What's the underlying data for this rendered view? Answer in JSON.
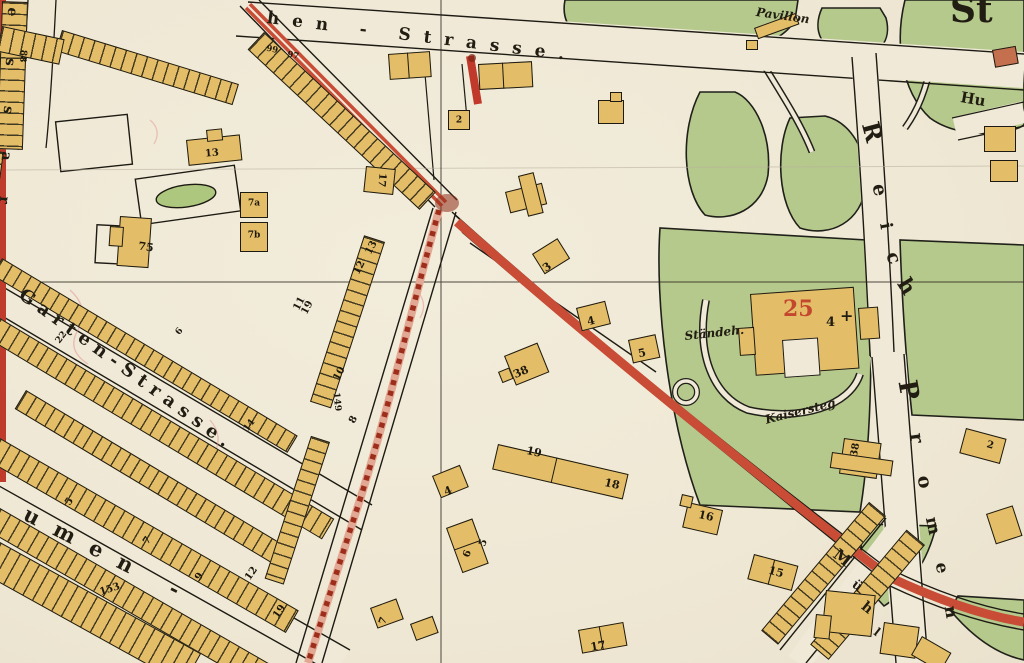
{
  "map_title": "Historic town plan fragment (German, ca. 1900)",
  "palette": {
    "paper": "#f0e9d7",
    "park_green": "#b5c98c",
    "building_yellow": "#e3bd68",
    "building_red": "#c4704f",
    "road_red": "#c84c36",
    "road_hatch_pink": "#e2a893",
    "road_hatch_dash": "#9e2e1c",
    "edge_red_strip": "#bf3b2c",
    "ink": "#1c1a12"
  },
  "street_labels": [
    {
      "t": "hen  -  Strasse.",
      "x": 268,
      "y": 10,
      "r": 7,
      "s": 17,
      "ls": 13
    },
    {
      "t": "Garten-Strasse.",
      "x": 26,
      "y": 286,
      "r": 36,
      "s": 18,
      "ls": 7
    },
    {
      "t": "umen  -",
      "x": 30,
      "y": 503,
      "r": 27,
      "s": 21,
      "ls": 18
    }
  ],
  "place_labels": [
    {
      "t": "Pavillon",
      "x": 757,
      "y": 6,
      "r": 8,
      "s": 12,
      "it": 1
    },
    {
      "t": "Ständeh.",
      "x": 684,
      "y": 330,
      "r": -6,
      "s": 12,
      "it": 1
    },
    {
      "t": "Kaisersteg",
      "x": 764,
      "y": 414,
      "r": -14,
      "s": 12,
      "it": 1
    },
    {
      "t": "Hu",
      "x": 962,
      "y": 90,
      "r": 10,
      "s": 15
    },
    {
      "t": "St",
      "x": 950,
      "y": -8,
      "r": 0,
      "s": 36
    },
    {
      "t": "25",
      "x": 783,
      "y": 298,
      "r": 0,
      "s": 22,
      "c": "#c03a28"
    },
    {
      "t": "4",
      "x": 826,
      "y": 316,
      "r": 0,
      "s": 13
    },
    {
      "t": "+",
      "x": 840,
      "y": 308,
      "r": 0,
      "s": 16
    }
  ],
  "vertical_letters": [
    {
      "t": "R",
      "x": 872,
      "y": 132,
      "r": 75,
      "s": 24
    },
    {
      "t": "e",
      "x": 879,
      "y": 190,
      "r": 78,
      "s": 19
    },
    {
      "t": "i",
      "x": 885,
      "y": 226,
      "r": 80,
      "s": 17
    },
    {
      "t": "c",
      "x": 893,
      "y": 258,
      "r": 70,
      "s": 19
    },
    {
      "t": "h",
      "x": 907,
      "y": 286,
      "r": 58,
      "s": 21
    },
    {
      "t": "P",
      "x": 908,
      "y": 390,
      "r": 80,
      "s": 26
    },
    {
      "t": "r",
      "x": 916,
      "y": 438,
      "r": 82,
      "s": 19
    },
    {
      "t": "o",
      "x": 924,
      "y": 482,
      "r": 80,
      "s": 19
    },
    {
      "t": "m",
      "x": 932,
      "y": 526,
      "r": 78,
      "s": 17
    },
    {
      "t": "e",
      "x": 941,
      "y": 568,
      "r": 80,
      "s": 17
    },
    {
      "t": "n",
      "x": 950,
      "y": 612,
      "r": 80,
      "s": 17
    },
    {
      "t": "M",
      "x": 842,
      "y": 558,
      "r": 38,
      "s": 16
    },
    {
      "t": "ü",
      "x": 857,
      "y": 586,
      "r": 38,
      "s": 13
    },
    {
      "t": "h",
      "x": 867,
      "y": 608,
      "r": 38,
      "s": 14
    },
    {
      "t": "l",
      "x": 877,
      "y": 632,
      "r": 38,
      "s": 12
    },
    {
      "t": "e",
      "x": 12,
      "y": 12,
      "r": 96,
      "s": 14
    },
    {
      "t": "s",
      "x": 10,
      "y": 62,
      "r": 96,
      "s": 14
    },
    {
      "t": "s",
      "x": 8,
      "y": 110,
      "r": 96,
      "s": 14
    },
    {
      "t": "a",
      "x": 6,
      "y": 156,
      "r": 96,
      "s": 14
    },
    {
      "t": "r",
      "x": 4,
      "y": 200,
      "r": 96,
      "s": 14
    }
  ],
  "house_numbers": [
    {
      "t": "2",
      "x": 459,
      "y": 121,
      "r": 0,
      "s": 9
    },
    {
      "t": "3",
      "x": 547,
      "y": 267,
      "r": -35,
      "s": 11
    },
    {
      "t": "4",
      "x": 591,
      "y": 321,
      "r": -14,
      "s": 11
    },
    {
      "t": "5",
      "x": 642,
      "y": 353,
      "r": -12,
      "s": 11
    },
    {
      "t": "38",
      "x": 521,
      "y": 372,
      "r": -24,
      "s": 11
    },
    {
      "t": "17",
      "x": 381,
      "y": 180,
      "r": 95,
      "s": 10
    },
    {
      "t": "13",
      "x": 212,
      "y": 154,
      "r": -5,
      "s": 10
    },
    {
      "t": "7a",
      "x": 254,
      "y": 204,
      "r": 0,
      "s": 9
    },
    {
      "t": "7b",
      "x": 254,
      "y": 236,
      "r": 0,
      "s": 9
    },
    {
      "t": "75",
      "x": 146,
      "y": 247,
      "r": 8,
      "s": 11
    },
    {
      "t": "13",
      "x": 372,
      "y": 248,
      "r": -62,
      "s": 10
    },
    {
      "t": "12",
      "x": 360,
      "y": 268,
      "r": -62,
      "s": 10
    },
    {
      "t": "11",
      "x": 300,
      "y": 304,
      "r": -62,
      "s": 10
    },
    {
      "t": "10",
      "x": 340,
      "y": 374,
      "r": -62,
      "s": 10
    },
    {
      "t": "8",
      "x": 354,
      "y": 420,
      "r": -62,
      "s": 10
    },
    {
      "t": "149",
      "x": 336,
      "y": 402,
      "r": 84,
      "s": 9
    },
    {
      "t": "19",
      "x": 308,
      "y": 308,
      "r": -62,
      "s": 10
    },
    {
      "t": "22",
      "x": 62,
      "y": 338,
      "r": -52,
      "s": 9
    },
    {
      "t": "6",
      "x": 180,
      "y": 332,
      "r": -52,
      "s": 9
    },
    {
      "t": "14",
      "x": 250,
      "y": 426,
      "r": -52,
      "s": 9
    },
    {
      "t": "5",
      "x": 70,
      "y": 502,
      "r": -55,
      "s": 10
    },
    {
      "t": "7",
      "x": 148,
      "y": 541,
      "r": -55,
      "s": 10
    },
    {
      "t": "153",
      "x": 110,
      "y": 590,
      "r": -18,
      "s": 10
    },
    {
      "t": "9",
      "x": 200,
      "y": 577,
      "r": -55,
      "s": 10
    },
    {
      "t": "12",
      "x": 252,
      "y": 574,
      "r": -55,
      "s": 10
    },
    {
      "t": "19",
      "x": 280,
      "y": 612,
      "r": -55,
      "s": 10
    },
    {
      "t": "19",
      "x": 534,
      "y": 452,
      "r": 13,
      "s": 11
    },
    {
      "t": "18",
      "x": 612,
      "y": 484,
      "r": 13,
      "s": 11
    },
    {
      "t": "16",
      "x": 706,
      "y": 516,
      "r": 13,
      "s": 11
    },
    {
      "t": "15",
      "x": 776,
      "y": 572,
      "r": 15,
      "s": 11
    },
    {
      "t": "17",
      "x": 598,
      "y": 646,
      "r": -10,
      "s": 11
    },
    {
      "t": "4",
      "x": 448,
      "y": 491,
      "r": -22,
      "s": 11
    },
    {
      "t": "6",
      "x": 468,
      "y": 554,
      "r": -70,
      "s": 10
    },
    {
      "t": "5",
      "x": 484,
      "y": 543,
      "r": -70,
      "s": 10
    },
    {
      "t": "7",
      "x": 384,
      "y": 621,
      "r": -70,
      "s": 10
    },
    {
      "t": "38",
      "x": 856,
      "y": 450,
      "r": -80,
      "s": 10
    },
    {
      "t": "2",
      "x": 990,
      "y": 446,
      "r": 15,
      "s": 10
    },
    {
      "t": "88",
      "x": 22,
      "y": 56,
      "r": 94,
      "s": 9
    },
    {
      "t": "99",
      "x": 272,
      "y": 50,
      "r": 12,
      "s": 8.5
    },
    {
      "t": "97",
      "x": 293,
      "y": 56,
      "r": 12,
      "s": 8.5
    }
  ],
  "buildings": [
    {
      "x": 448,
      "y": 110,
      "w": 22,
      "h": 20,
      "r": 0
    },
    {
      "x": 505,
      "y": 192,
      "w": 38,
      "h": 22,
      "r": -14
    },
    {
      "x": 518,
      "y": 176,
      "w": 16,
      "h": 42,
      "r": -14
    },
    {
      "x": 532,
      "y": 254,
      "w": 30,
      "h": 24,
      "r": -32
    },
    {
      "x": 576,
      "y": 308,
      "w": 30,
      "h": 24,
      "r": -14
    },
    {
      "x": 628,
      "y": 340,
      "w": 28,
      "h": 24,
      "r": -12
    },
    {
      "x": 504,
      "y": 356,
      "w": 36,
      "h": 32,
      "r": -22
    },
    {
      "x": 498,
      "y": 372,
      "w": 12,
      "h": 12,
      "r": -22
    },
    {
      "x": 366,
      "y": 166,
      "w": 30,
      "h": 26,
      "r": 6
    },
    {
      "x": 186,
      "y": 140,
      "w": 54,
      "h": 26,
      "r": -6
    },
    {
      "x": 206,
      "y": 130,
      "w": 16,
      "h": 12,
      "r": -6
    },
    {
      "x": 240,
      "y": 192,
      "w": 28,
      "h": 26,
      "r": 0
    },
    {
      "x": 240,
      "y": 222,
      "w": 28,
      "h": 30,
      "r": 0
    },
    {
      "x": 120,
      "y": 216,
      "w": 32,
      "h": 50,
      "r": 4
    },
    {
      "x": 110,
      "y": 226,
      "w": 14,
      "h": 20,
      "r": 4
    },
    {
      "x": 388,
      "y": 54,
      "w": 42,
      "h": 26,
      "r": -4,
      "d": 1
    },
    {
      "x": 478,
      "y": 64,
      "w": 54,
      "h": 26,
      "r": -3,
      "d": 1
    },
    {
      "x": 598,
      "y": 100,
      "w": 26,
      "h": 24,
      "r": 0
    },
    {
      "x": 610,
      "y": 92,
      "w": 12,
      "h": 10,
      "r": 0
    },
    {
      "x": 498,
      "y": 444,
      "w": 134,
      "h": 26,
      "r": 13,
      "d": 1
    },
    {
      "x": 688,
      "y": 502,
      "w": 36,
      "h": 26,
      "r": 13
    },
    {
      "x": 682,
      "y": 494,
      "w": 12,
      "h": 12,
      "r": 13
    },
    {
      "x": 754,
      "y": 554,
      "w": 46,
      "h": 26,
      "r": 15,
      "d": 1
    },
    {
      "x": 578,
      "y": 630,
      "w": 46,
      "h": 24,
      "r": -10,
      "d": 1
    },
    {
      "x": 432,
      "y": 476,
      "w": 30,
      "h": 24,
      "r": -22
    },
    {
      "x": 446,
      "y": 528,
      "w": 28,
      "h": 48,
      "r": -20,
      "d": 2
    },
    {
      "x": 370,
      "y": 608,
      "w": 28,
      "h": 22,
      "r": -20
    },
    {
      "x": 410,
      "y": 624,
      "w": 24,
      "h": 18,
      "r": -20
    },
    {
      "x": 984,
      "y": 126,
      "w": 32,
      "h": 26,
      "r": 0
    },
    {
      "x": 990,
      "y": 160,
      "w": 28,
      "h": 22,
      "r": 0
    },
    {
      "x": 992,
      "y": 50,
      "w": 24,
      "h": 18,
      "r": -10,
      "f": "#c4704f"
    },
    {
      "x": 826,
      "y": 590,
      "w": 50,
      "h": 42,
      "r": 6
    },
    {
      "x": 816,
      "y": 614,
      "w": 16,
      "h": 24,
      "r": 6
    },
    {
      "x": 884,
      "y": 622,
      "w": 36,
      "h": 32,
      "r": 8
    },
    {
      "x": 966,
      "y": 428,
      "w": 42,
      "h": 26,
      "r": 15
    },
    {
      "x": 986,
      "y": 514,
      "w": 28,
      "h": 32,
      "r": -18
    },
    {
      "x": 754,
      "y": 28,
      "w": 44,
      "h": 12,
      "r": -20
    },
    {
      "x": 746,
      "y": 40,
      "w": 12,
      "h": 10,
      "r": 0
    },
    {
      "x": 844,
      "y": 438,
      "w": 38,
      "h": 36,
      "r": 8
    },
    {
      "x": 832,
      "y": 452,
      "w": 62,
      "h": 16,
      "r": 8
    },
    {
      "x": 750,
      "y": 294,
      "w": 104,
      "h": 82,
      "r": -4
    },
    {
      "x": 858,
      "y": 308,
      "w": 20,
      "h": 32,
      "r": -4
    },
    {
      "x": 738,
      "y": 328,
      "w": 16,
      "h": 28,
      "r": -4
    },
    {
      "x": 782,
      "y": 340,
      "w": 36,
      "h": 38,
      "r": -4,
      "f": "paper"
    },
    {
      "x": 922,
      "y": 636,
      "w": 34,
      "h": 22,
      "r": 30
    }
  ],
  "terrace_rows": [
    {
      "x": 28,
      "y": 2,
      "w": 148,
      "h": 26,
      "r": 92
    },
    {
      "x": 4,
      "y": 152,
      "w": 125,
      "h": 22,
      "r": 98
    },
    {
      "x": 62,
      "y": 30,
      "w": 185,
      "h": 22,
      "r": 17
    },
    {
      "x": 264,
      "y": 32,
      "w": 235,
      "h": 24,
      "r": 43
    },
    {
      "x": 2,
      "y": 258,
      "w": 345,
      "h": 20,
      "r": 31
    },
    {
      "x": 0,
      "y": 318,
      "w": 390,
      "h": 24,
      "r": 31
    },
    {
      "x": 26,
      "y": 390,
      "w": 310,
      "h": 22,
      "r": 31
    },
    {
      "x": 0,
      "y": 438,
      "w": 345,
      "h": 26,
      "r": 30
    },
    {
      "x": 0,
      "y": 508,
      "w": 330,
      "h": 26,
      "r": 30
    },
    {
      "x": 0,
      "y": 542,
      "w": 230,
      "h": 36,
      "r": 29
    },
    {
      "x": 385,
      "y": 242,
      "w": 175,
      "h": 22,
      "r": 108
    },
    {
      "x": 330,
      "y": 442,
      "w": 150,
      "h": 20,
      "r": 108
    },
    {
      "x": 886,
      "y": 516,
      "w": 168,
      "h": 22,
      "r": 130
    },
    {
      "x": 925,
      "y": 545,
      "w": 150,
      "h": 24,
      "r": 130
    },
    {
      "x": 2,
      "y": 26,
      "w": 64,
      "h": 26,
      "r": 12
    }
  ]
}
